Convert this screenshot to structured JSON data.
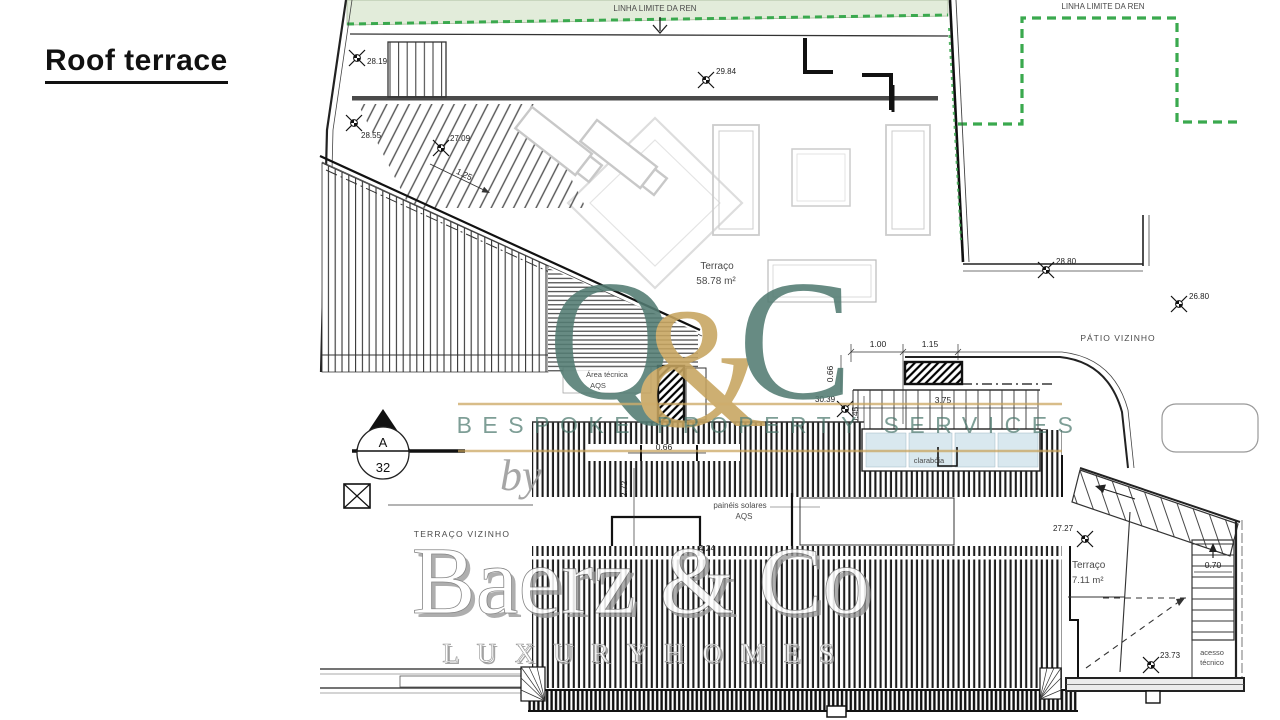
{
  "title": "Roof terrace",
  "watermark": {
    "logo_q": "Q",
    "logo_amp": "&",
    "logo_c": "C",
    "tagline": "BESPOKE PROPERTY SERVICES",
    "by": "by",
    "brand": "Baerz & Co",
    "brand_sub": "L U X U R Y   H O M E S",
    "teal": "#527c72",
    "gold": "#c6a45f"
  },
  "plan": {
    "boundary": {
      "ren_top": "LINHA LIMITE DA REN",
      "ren_right": "LINHA LIMITE DA REN",
      "ren_green": "#3aa94e",
      "ren_fill": "#e2ecda"
    },
    "areas": {
      "main_terrace": "Terraço",
      "main_terrace_area": "58.78 m²",
      "small_terrace": "Terraço",
      "small_terrace_area": "7.11 m²",
      "patio_neighbor": "PÁTIO VIZINHO",
      "terrace_neighbor": "TERRAÇO VIZINHO",
      "tech_area_line1": "Área técnica",
      "tech_area_line2": "AQS",
      "skylight": "clarabóia",
      "skylight_fill": "#d9e8ef",
      "solar_line1": "painéis solares",
      "solar_line2": "AQS",
      "access_line1": "acesso",
      "access_line2": "técnico"
    },
    "section_marker": {
      "letter": "A",
      "number": "32"
    },
    "elevations": {
      "e2819": "28.19",
      "e2855": "28.55",
      "e2709": "27.09",
      "e2984": "29.84",
      "e2880": "28.80",
      "e2680": "26.80",
      "e3039": "30.39",
      "e2727": "27.27",
      "e2373": "23.73"
    },
    "dims": {
      "d125": "1.25",
      "d100": "1.00",
      "d115": "1.15",
      "d066": "0.66",
      "d045": "0.45",
      "d375": "3.75",
      "d272": "2.72",
      "d424": "4.24",
      "d070": "0.70"
    }
  }
}
